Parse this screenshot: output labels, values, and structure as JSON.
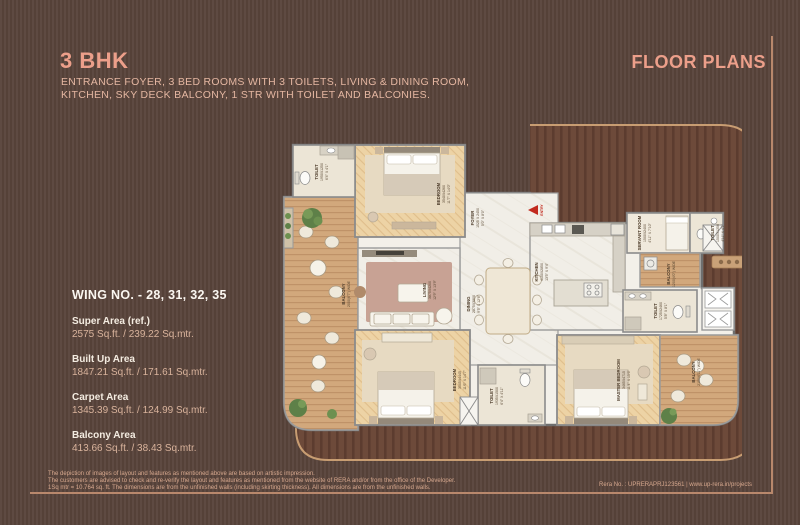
{
  "header": {
    "title": "3 BHK",
    "description_line1": "ENTRANCE FOYER, 3 BED ROOMS WITH 3 TOILETS, LIVING & DINING ROOM,",
    "description_line2": "KITCHEN, SKY DECK BALCONY, 1 STR WITH TOILET AND BALCONIES.",
    "floor_plans_label": "FLOOR PLANS"
  },
  "wing_panel": {
    "title": "WING NO. - 28, 31, 32, 35",
    "areas": [
      {
        "label": "Super Area (ref.)",
        "value": "2575 Sq.ft. / 239.22 Sq.mtr."
      },
      {
        "label": "Built Up Area",
        "value": "1847.21 Sq.ft. / 171.61 Sq.mtr."
      },
      {
        "label": "Carpet Area",
        "value": "1345.39 Sq.ft. / 124.99 Sq.mtr."
      },
      {
        "label": "Balcony Area",
        "value": "413.66 Sq.ft. / 38.43 Sq.mtr."
      }
    ]
  },
  "plan": {
    "entry_label": "ENTRY",
    "rooms": [
      {
        "name": "TOILET",
        "size_mm": "1950X1250",
        "size_ft": "6'4\" X 4'1\""
      },
      {
        "name": "BEDROOM",
        "size_mm": "3540X4260",
        "size_ft": "11'7\" X 14'0\""
      },
      {
        "name": "FOYER",
        "size_mm": "1525 X 2450",
        "size_ft": "5'0\" X 8'0\""
      },
      {
        "name": "KITCHEN",
        "size_mm": "4100X2850",
        "size_ft": "13'5\" X 9'4\""
      },
      {
        "name": "SERVANT ROOM",
        "size_mm": "1500X2400",
        "size_ft": "4'11\" X 7'10\""
      },
      {
        "name": "TOILET",
        "size_mm": "1500X1250",
        "size_ft": "4'11\" X 4'1\""
      },
      {
        "name": "BALCONY",
        "size_mm": "1200(4'0\") WIDE",
        "size_ft": ""
      },
      {
        "name": "TOILET",
        "size_mm": "1725X2460",
        "size_ft": "5'8\" X 8'1\""
      },
      {
        "name": "MASTER BEDROOM",
        "size_mm": "3465X4715",
        "size_ft": "11'4\" X 15'6\""
      },
      {
        "name": "BALCONY",
        "size_mm": "2100(6'11\") WIDE",
        "size_ft": ""
      },
      {
        "name": "BEDROOM",
        "size_mm": "3505X4445",
        "size_ft": "11'6\" X 14'7\""
      },
      {
        "name": "TOILET",
        "size_mm": "1935X1500",
        "size_ft": "6'4\" X 4'11\""
      },
      {
        "name": "LIVING",
        "size_mm": "3875X4200",
        "size_ft": "12'9\" X 13'9\""
      },
      {
        "name": "DINING",
        "size_mm": "2875X3800",
        "size_ft": "9'5\" X 12'6\""
      },
      {
        "name": "BALCONY",
        "size_mm": "2000(6'7\") WIDE",
        "size_ft": ""
      }
    ]
  },
  "footer": {
    "disclaimer_line1": "The depiction of images of layout and features as mentioned above are based on artistic impression.",
    "disclaimer_line2": "The customers are advised to check and re-verify the layout and features as mentioned from the website of RERA and/or from the office of the Developer.",
    "disclaimer_line3": "1Sq mtr = 10.764 sq. ft. The dimensions are from the unfinished walls (including skirting thickness). All dimensions are from the unfinished walls.",
    "rera": "Rera No. : UPRERAPRJ123561 | www.up-rera.in/projects"
  }
}
